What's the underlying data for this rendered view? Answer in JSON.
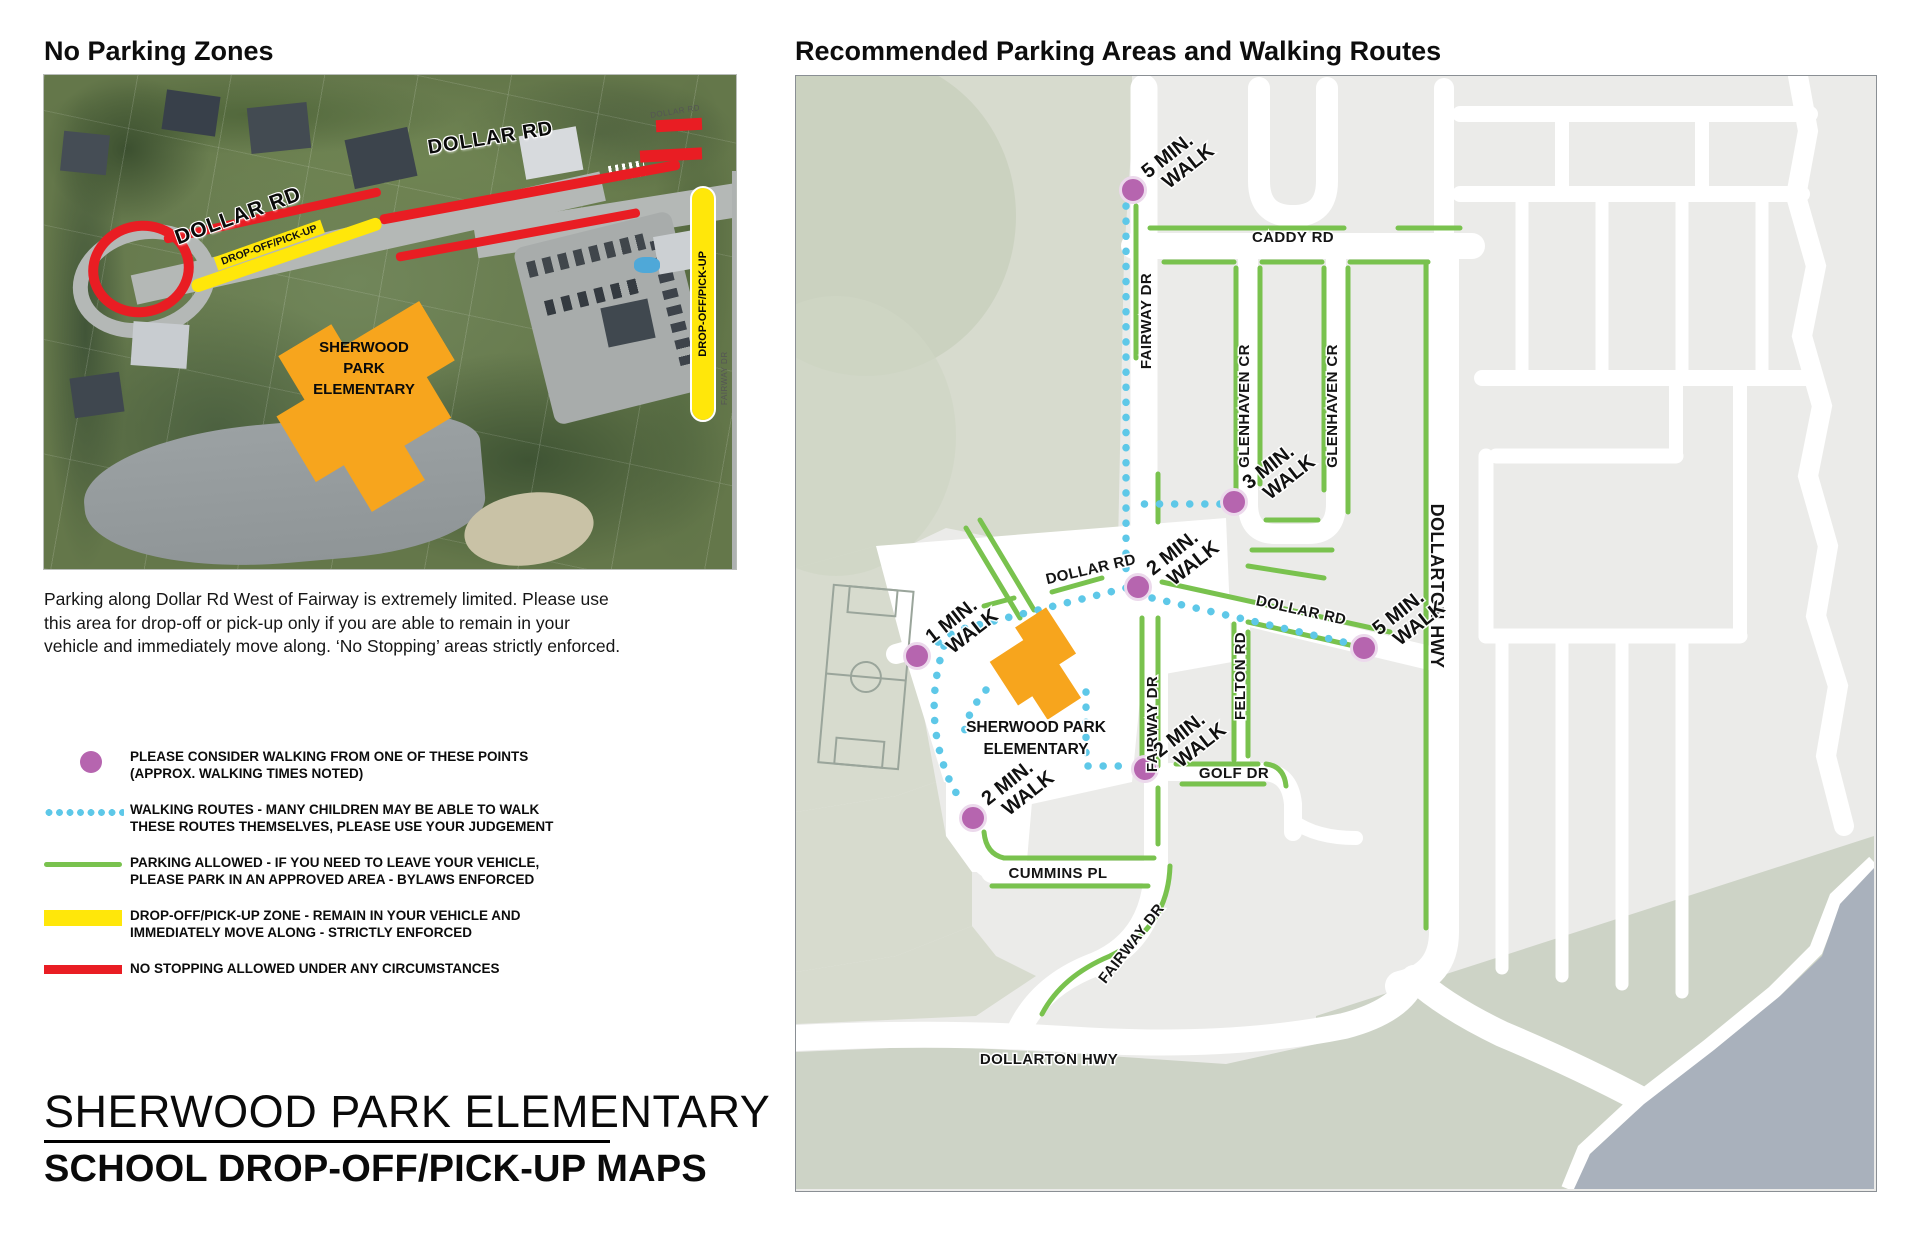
{
  "left_panel": {
    "title": "No Parking Zones",
    "photo_labels": {
      "dollar_rd_upper": "DOLLAR RD",
      "dollar_rd_lower": "DOLLAR RD",
      "dropoff_strip": "DROP-OFF/PICK-UP",
      "dropoff_bar": "DROP-OFF/PICK-UP",
      "school_line1": "SHERWOOD",
      "school_line2": "PARK",
      "school_line3": "ELEMENTARY",
      "small_fairway": "FAIRWAY DR",
      "small_dollar": "DOLLAR RD"
    },
    "caption": "Parking along Dollar Rd West of Fairway is extremely limited. Please use this area for drop-off or pick-up only if you are able to remain in your vehicle and immediately move along.  ‘No Stopping’ areas strictly enforced.",
    "legend": [
      {
        "swatch": "walk-point-dot",
        "line1": "PLEASE CONSIDER WALKING FROM ONE OF THESE POINTS",
        "line2": "(APPROX. WALKING TIMES NOTED)"
      },
      {
        "swatch": "walking-route-dotted",
        "line1": "WALKING ROUTES - MANY CHILDREN MAY BE ABLE TO WALK",
        "line2": "THESE ROUTES THEMSELVES, PLEASE USE YOUR JUDGEMENT"
      },
      {
        "swatch": "parking-allowed-line",
        "line1": "PARKING ALLOWED - IF YOU NEED TO LEAVE YOUR VEHICLE,",
        "line2": "PLEASE PARK IN AN APPROVED AREA - BYLAWS ENFORCED"
      },
      {
        "swatch": "dropoff-zone-bar",
        "line1": "DROP-OFF/PICK-UP ZONE - REMAIN IN YOUR VEHICLE AND",
        "line2": "IMMEDIATELY MOVE ALONG - STRICTLY ENFORCED"
      },
      {
        "swatch": "no-stopping-bar",
        "line1": "NO STOPPING ALLOWED UNDER ANY CIRCUMSTANCES",
        "line2": ""
      }
    ],
    "footer_line1": "SHERWOOD PARK ELEMENTARY",
    "footer_line2": "SCHOOL DROP-OFF/PICK-UP MAPS"
  },
  "right_panel": {
    "title": "Recommended Parking Areas and Walking Routes",
    "streets": {
      "caddy": "CADDY RD",
      "fairway": "FAIRWAY DR",
      "glenhaven": "GLENHAVEN CR",
      "dollarton": "DOLLARTON HWY",
      "dollar": "DOLLAR RD",
      "felton": "FELTON RD",
      "golf": "GOLF DR",
      "cummins": "CUMMINS PL"
    },
    "school_label_line1": "SHERWOOD PARK",
    "school_label_line2": "ELEMENTARY",
    "walks": [
      {
        "l1": "5 MIN.",
        "l2": "WALK"
      },
      {
        "l1": "3 MIN.",
        "l2": "WALK"
      },
      {
        "l1": "2 MIN.",
        "l2": "WALK"
      },
      {
        "l1": "5 MIN.",
        "l2": "WALK"
      },
      {
        "l1": "1 MIN.",
        "l2": "WALK"
      },
      {
        "l1": "2 MIN.",
        "l2": "WALK"
      },
      {
        "l1": "2 MIN.",
        "l2": "WALK"
      }
    ]
  },
  "colors": {
    "walk_point_purple": "#b665af",
    "route_blue": "#5ec8e8",
    "parking_green": "#79c24e",
    "dropoff_yellow": "#ffe70a",
    "no_stopping_red": "#e91d23",
    "school_orange": "#f7a51d",
    "water_gray_blue": "#a9b1bc",
    "land_green_gray": "#d7dbce"
  }
}
